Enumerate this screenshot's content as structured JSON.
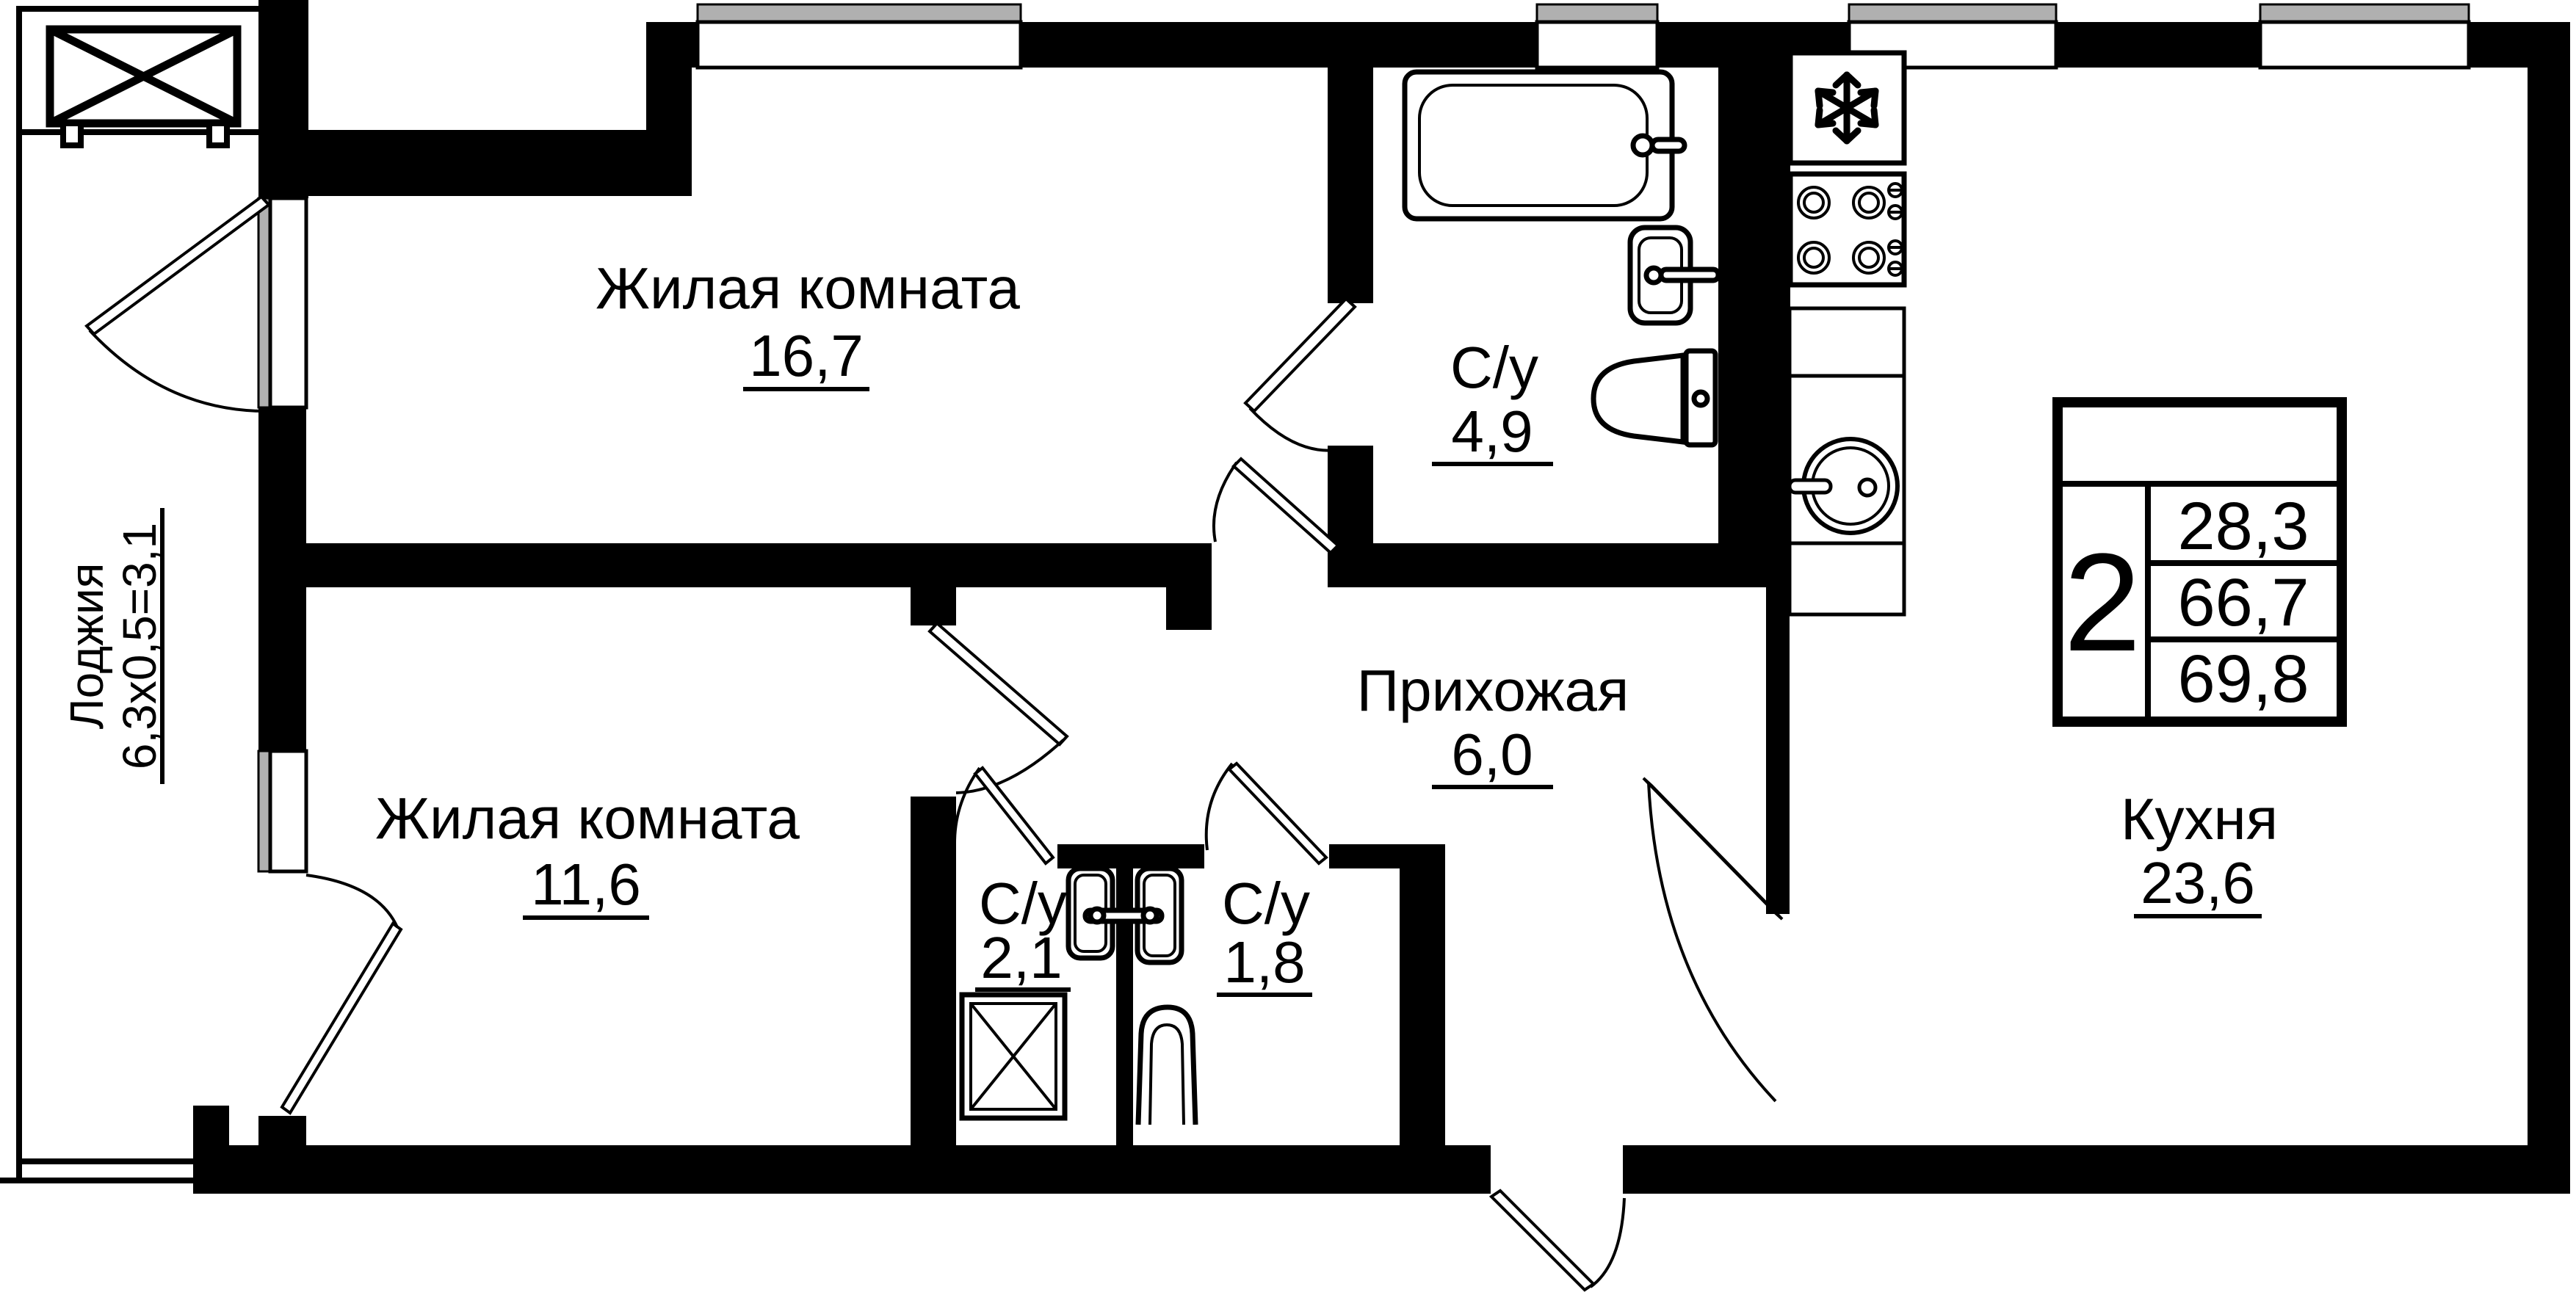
{
  "rooms": {
    "living1": {
      "label": "Жилая комната",
      "area": "16,7"
    },
    "living2": {
      "label": "Жилая комната",
      "area": "11,6"
    },
    "bath1": {
      "label": "С/у",
      "area": "4,9"
    },
    "bath2": {
      "label": "С/у",
      "area": "2,1"
    },
    "bath3": {
      "label": "С/у",
      "area": "1,8"
    },
    "hallway": {
      "label": "Прихожая",
      "area": "6,0"
    },
    "kitchen": {
      "label": "Кухня",
      "area": "23,6"
    },
    "loggia": {
      "label": "Лоджия",
      "dimensions": "6,3х0,5=3,1"
    }
  },
  "legend": {
    "rooms_count": "2",
    "living_area": "28,3",
    "usable_area": "66,7",
    "total_area": "69,8"
  },
  "colors": {
    "wall": "#000000",
    "glass": "#b0b0b0",
    "background": "#ffffff"
  }
}
